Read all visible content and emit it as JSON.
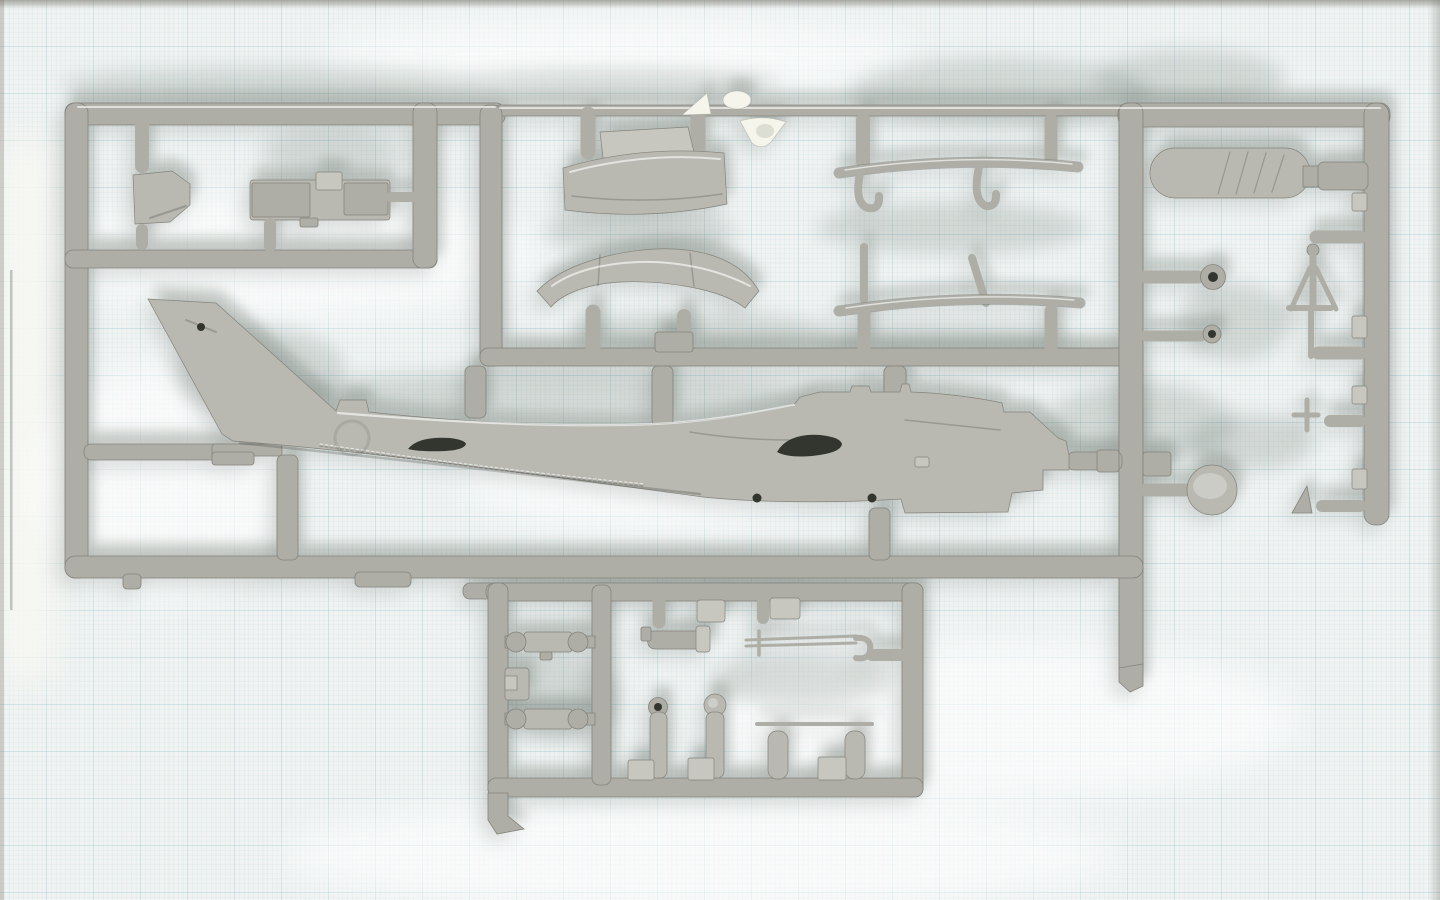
{
  "scene": {
    "type": "photograph",
    "subject": "Gray injection-molded plastic model-kit sprue with helicopter parts laid on pale blue graph paper",
    "text_visible": "none"
  },
  "colors": {
    "paper": "#f0f3f2",
    "paper_margin": "#f7f7f2",
    "grid_minor": "#a9cdd6",
    "grid_major": "#7fb6c4",
    "plastic": "#aeaea7",
    "plastic_light": "#c7c7c0",
    "plastic_mid": "#b9b9b2",
    "plastic_dark": "#84847d",
    "hole": "#33362e",
    "clear": "#f6f5ec",
    "shadow": "#6f7a72",
    "photo_edge": "#8d8a80"
  },
  "sprue": {
    "frame": {
      "top_rail": [
        65,
        103,
        1325,
        24
      ],
      "left_rail": [
        65,
        103,
        23,
        475
      ],
      "right_rail": [
        1364,
        103,
        25,
        422
      ],
      "central_rail": [
        1119,
        103,
        24,
        585
      ],
      "mid_rail": [
        480,
        348,
        663,
        18
      ],
      "second_rail_left": [
        65,
        250,
        372,
        18
      ],
      "bottom_rail": [
        65,
        556,
        1078,
        22
      ],
      "sub_frame": [
        486,
        583,
        437,
        214
      ]
    },
    "parts": [
      {
        "name": "fuselage-half",
        "label": "helicopter fuselage half with tail fin",
        "region": [
          148,
          297,
          925,
          216
        ]
      },
      {
        "name": "canopy-windshield",
        "label": "curved canopy / windshield panel",
        "region": [
          563,
          112,
          165,
          108
        ]
      },
      {
        "name": "stabilizer-fairing",
        "label": "curved stabilizer fairing",
        "region": [
          535,
          248,
          226,
          104
        ]
      },
      {
        "name": "seat-bulkhead",
        "label": "seat / bulkhead pentagon part",
        "region": [
          128,
          112,
          64,
          138
        ]
      },
      {
        "name": "instrument-panel",
        "label": "instrument panel assembly",
        "region": [
          247,
          170,
          145,
          80
        ]
      },
      {
        "name": "landing-skid-upper",
        "label": "landing skid with cross-tube hooks",
        "region": [
          839,
          117,
          241,
          95
        ]
      },
      {
        "name": "landing-skid-lower",
        "label": "landing skid with support legs",
        "region": [
          839,
          243,
          241,
          110
        ]
      },
      {
        "name": "rotor-paddle",
        "label": "rounded paddle / hub plate",
        "region": [
          1150,
          147,
          215,
          52
        ]
      },
      {
        "name": "ring-small-1",
        "label": "small ring with hole",
        "region": [
          1200,
          264,
          26,
          26
        ]
      },
      {
        "name": "ring-small-2",
        "label": "small ring with hole",
        "region": [
          1203,
          325,
          18,
          18
        ]
      },
      {
        "name": "wheel-disc",
        "label": "large disc / hub",
        "region": [
          1187,
          465,
          50,
          50
        ]
      },
      {
        "name": "antenna-mast",
        "label": "mast with two angled legs",
        "region": [
          1288,
          243,
          50,
          115
        ]
      },
      {
        "name": "t-pin",
        "label": "small T pin",
        "region": [
          1292,
          398,
          28,
          33
        ]
      },
      {
        "name": "nose-cone",
        "label": "small cone",
        "region": [
          1290,
          486,
          24,
          28
        ]
      },
      {
        "name": "clear-sprue-bits",
        "label": "translucent clear parts on rail",
        "region": [
          680,
          90,
          110,
          62
        ]
      },
      {
        "name": "barbell-link-1",
        "label": "barbell shaped control link",
        "region": [
          505,
          630,
          85,
          24
        ]
      },
      {
        "name": "barbell-link-2",
        "label": "barbell shaped control link",
        "region": [
          505,
          707,
          85,
          24
        ]
      },
      {
        "name": "small-block",
        "label": "notched block",
        "region": [
          503,
          666,
          28,
          36
        ]
      },
      {
        "name": "exhaust-pipe",
        "label": "elbow exhaust pipe",
        "region": [
          643,
          593,
          70,
          58
        ]
      },
      {
        "name": "cabin-block-1",
        "label": "small box part",
        "region": [
          695,
          593,
          32,
          30
        ]
      },
      {
        "name": "cabin-block-2",
        "label": "small box part",
        "region": [
          755,
          593,
          46,
          28
        ]
      },
      {
        "name": "gun-barrel-rod",
        "label": "thin twin-rod / barrel with hook",
        "region": [
          743,
          628,
          135,
          35
        ]
      },
      {
        "name": "ring-post-1",
        "label": "post with ring top",
        "region": [
          628,
          697,
          42,
          84
        ]
      },
      {
        "name": "disc-post-2",
        "label": "post with disc top",
        "region": [
          688,
          694,
          46,
          87
        ]
      },
      {
        "name": "rod-with-posts",
        "label": "thin rod with two posts",
        "region": [
          757,
          720,
          115,
          60
        ]
      }
    ],
    "part_count_visible": 26
  }
}
